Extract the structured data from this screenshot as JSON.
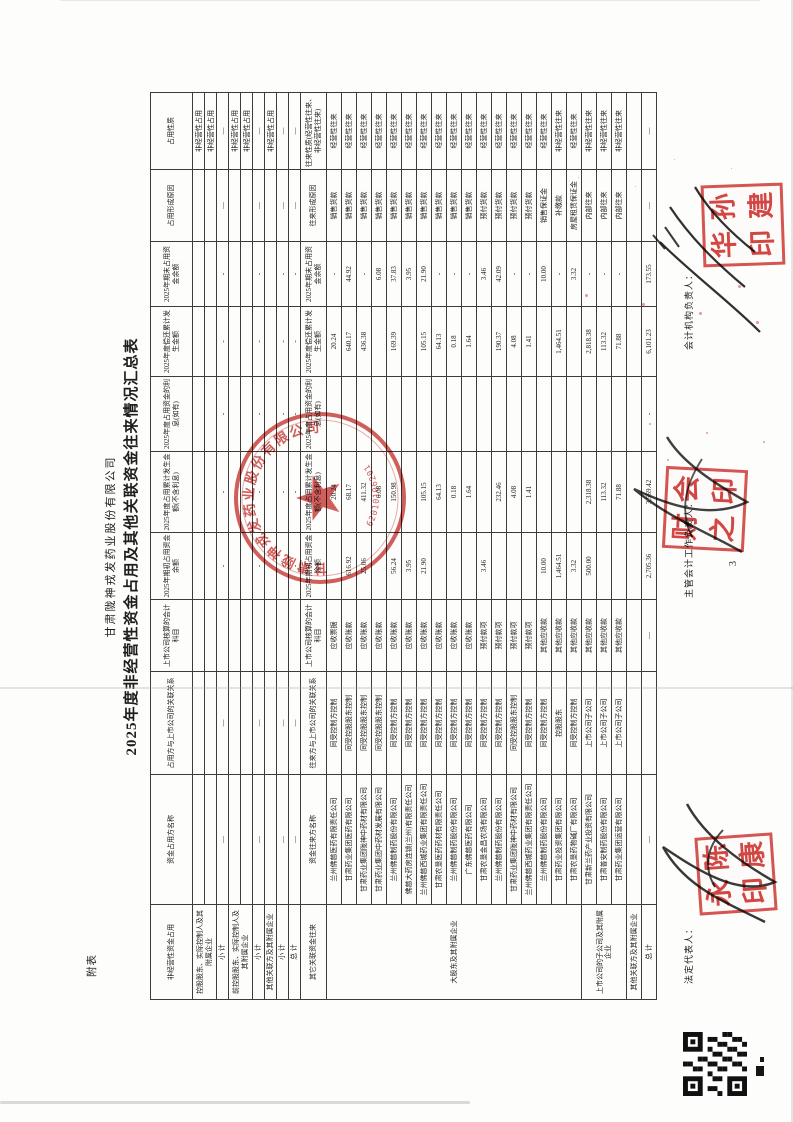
{
  "page": {
    "corner_label": "附表",
    "page_number": "3"
  },
  "title": {
    "company": "甘肃陇神戎发药业股份有限公司",
    "report": "2025年度非经营性资金占用及其他关联资金往来情况汇总表"
  },
  "table": {
    "section1_headers": [
      "非经营性资金占用",
      "资金占用方名称",
      "占用方与上市公司的关联关系",
      "上市公司核算的会计科目",
      "2025年期初占用资金余额",
      "2025年度占用累计发生金额(不含利息)",
      "2025年度占用资金的利息(如有)",
      "2025年度偿还累计发生金额",
      "2025年期末占用资金余额",
      "占用形成原因",
      "占用性质"
    ],
    "section2_headers": [
      "其它关联资金往来",
      "资金往来方名称",
      "往来方与上市公司的关联关系",
      "上市公司核算的会计科目",
      "2025年期初占用资金余额",
      "2025年度占用累计发生金额(不含利息)",
      "2025年度占用资金的利息(如有)",
      "2025年度偿还累计发生金额",
      "2025年期末占用资金余额",
      "往来形成原因",
      "往来性质(经营性往来、非经营性往来)"
    ],
    "section1_rows": [
      {
        "cat": "控股股东、实际控制人及其附属企业",
        "span": 2,
        "cells": [
          "",
          "",
          "",
          "",
          "",
          "",
          "",
          "",
          "",
          "非经营性占用"
        ]
      },
      {
        "cells": [
          "",
          "",
          "",
          "",
          "",
          "",
          "",
          "",
          "",
          "非经营性占用"
        ]
      },
      {
        "cat": "小  计",
        "cells": [
          "—",
          "—",
          "",
          "-",
          "-",
          "-",
          "-",
          "-",
          "—",
          "—"
        ]
      },
      {
        "cat": "前控股股东、实际控制人及其附属企业",
        "span": 2,
        "cells": [
          "",
          "",
          "",
          "",
          "",
          "",
          "",
          "",
          "",
          "非经营性占用"
        ]
      },
      {
        "cells": [
          "",
          "",
          "",
          "",
          "",
          "",
          "",
          "",
          "",
          "非经营性占用"
        ]
      },
      {
        "cat": "小  计",
        "cells": [
          "—",
          "—",
          "",
          "-",
          "-",
          "-",
          "-",
          "-",
          "—",
          "—"
        ]
      },
      {
        "cat": "其他关联方及其附属企业",
        "cells": [
          "",
          "",
          "",
          "",
          "",
          "",
          "",
          "",
          "",
          "非经营性占用"
        ]
      },
      {
        "cat": "小  计",
        "cells": [
          "—",
          "—",
          "",
          "-",
          "-",
          "-",
          "-",
          "-",
          "—",
          "—"
        ]
      },
      {
        "cat": "总  计",
        "cells": [
          "—",
          "—",
          "",
          "-",
          "-",
          "-",
          "-",
          "-",
          "—",
          "—"
        ]
      }
    ],
    "section2_rows": [
      {
        "cat": "大股东及其附属企业",
        "span": 17,
        "cells": [
          "兰州佛慈医药有限责任公司",
          "同受控制方控制",
          "应收票据",
          "",
          "20.24",
          "",
          "20.24",
          "-",
          "销售货款",
          "经营性往来"
        ]
      },
      {
        "cells": [
          "甘肃药业集团医药有限公司",
          "同受控股股东控制",
          "应收账款",
          "616.92",
          "68.17",
          "",
          "640.17",
          "44.92",
          "销售货款",
          "经营性往来"
        ]
      },
      {
        "cells": [
          "甘肃药业集团陇神中药材有限公司",
          "同受控股股东控制",
          "应收账款",
          "25.06",
          "411.32",
          "",
          "436.38",
          "-",
          "销售货款",
          "经营性往来"
        ]
      },
      {
        "cells": [
          "甘肃药业集团中药材发展有限公司",
          "同受控股股东控制",
          "应收账款",
          "",
          "6.08",
          "",
          "",
          "6.08",
          "销售货款",
          "经营性往来"
        ]
      },
      {
        "cells": [
          "兰州佛慈制药股份有限公司",
          "同受控制方控制",
          "应收账款",
          "56.24",
          "150.98",
          "",
          "169.39",
          "37.83",
          "销售货款",
          "经营性往来"
        ]
      },
      {
        "cells": [
          "佛慈大药房连锁(兰州)有限责任公司",
          "同受控制方控制",
          "应收账款",
          "3.95",
          "",
          "",
          "",
          "3.95",
          "销售货款",
          "经营性往来"
        ]
      },
      {
        "cells": [
          "兰州佛慈西城药业集团有限责任公司",
          "同受控制方控制",
          "应收账款",
          "21.90",
          "105.15",
          "",
          "105.15",
          "21.90",
          "销售货款",
          "经营性往来"
        ]
      },
      {
        "cells": [
          "甘肃农垦医药药材有限责任公司",
          "同受控制方控制",
          "应收账款",
          "",
          "64.13",
          "",
          "64.13",
          "-",
          "销售货款",
          "经营性往来"
        ]
      },
      {
        "cells": [
          "兰州佛慈制药股份有限公司",
          "同受控制方控制",
          "应收账款",
          "",
          "0.18",
          "",
          "0.18",
          "-",
          "销售货款",
          "经营性往来"
        ]
      },
      {
        "cells": [
          "广东佛慈医药有限公司",
          "同受控制方控制",
          "应收账款",
          "",
          "1.64",
          "",
          "1.64",
          "-",
          "销售货款",
          "经营性往来"
        ]
      },
      {
        "cells": [
          "甘肃农垦金昌农场有限公司",
          "同受控制方控制",
          "预付款项",
          "3.46",
          "",
          "",
          "",
          "3.46",
          "预付货款",
          "经营性往来"
        ]
      },
      {
        "cells": [
          "兰州佛慈制药股份有限公司",
          "同受控制方控制",
          "预付款项",
          "",
          "232.46",
          "",
          "190.37",
          "42.09",
          "预付货款",
          "经营性往来"
        ]
      },
      {
        "cells": [
          "甘肃药业集团陇神中药材有限公司",
          "同受控股股东控制",
          "预付款项",
          "",
          "4.08",
          "",
          "4.08",
          "-",
          "预付货款",
          "经营性往来"
        ]
      },
      {
        "cells": [
          "兰州佛慈西城药业集团有限责任公司",
          "同受控制方控制",
          "预付款项",
          "",
          "1.41",
          "",
          "1.41",
          "-",
          "预付货款",
          "经营性往来"
        ]
      },
      {
        "cells": [
          "兰州佛慈制药股份有限公司",
          "同受控制方控制",
          "其他应收款",
          "10.00",
          "",
          "",
          "",
          "10.00",
          "销售保证金",
          "经营性往来"
        ]
      },
      {
        "cells": [
          "甘肃药业投资集团有限公司",
          "控股股东",
          "其他应收款",
          "1,464.51",
          "",
          "",
          "1,464.51",
          "-",
          "补缴款",
          "非经营性往来"
        ]
      },
      {
        "cells": [
          "甘肃农垦药物碱厂有限公司",
          "同受控制方控制",
          "其他应收款",
          "3.32",
          "",
          "",
          "",
          "3.32",
          "房屋租赁保证金",
          "经营性往来"
        ]
      },
      {
        "cat": "上市公司的子公司及其附属企业",
        "span": 3,
        "cells": [
          "甘肃新兰药产业投资有限公司",
          "上市公司子公司",
          "其他应收款",
          "500.00",
          "2,318.38",
          "",
          "2,818.38",
          "-",
          "内部往来",
          "非经营性往来"
        ]
      },
      {
        "cells": [
          "甘肃普安制药股份有限公司",
          "上市公司子公司",
          "其他应收款",
          "",
          "113.32",
          "",
          "113.32",
          "-",
          "内部往来",
          "非经营性往来"
        ]
      },
      {
        "cells": [
          "甘肃药业集团运营有限公司",
          "上市公司子公司",
          "其他应收款",
          "",
          "71.88",
          "",
          "71.88",
          "-",
          "内部往来",
          "非经营性往来"
        ]
      },
      {
        "cat": "其他关联方及其附属企业",
        "cells": [
          "",
          "",
          "",
          "",
          "",
          "",
          "",
          "",
          "",
          ""
        ]
      },
      {
        "cat": "总  计",
        "cells": [
          "—",
          "",
          "—",
          "2,705.36",
          "3,569.42",
          "-",
          "6,101.23",
          "173.55",
          "—",
          "—"
        ]
      }
    ]
  },
  "footer": {
    "legal_rep": "法定代表人：",
    "chief_accountant": "主管会计工作负责人：",
    "accounting_head": "会计机构负责人："
  },
  "seals": {
    "company_seal_text": "甘肃陇神戎发药业股份有限公司",
    "company_seal_serial": "6201010620103",
    "legal_rep_seal": "陈康永印",
    "accounting_head_seal": "孙建华印"
  }
}
